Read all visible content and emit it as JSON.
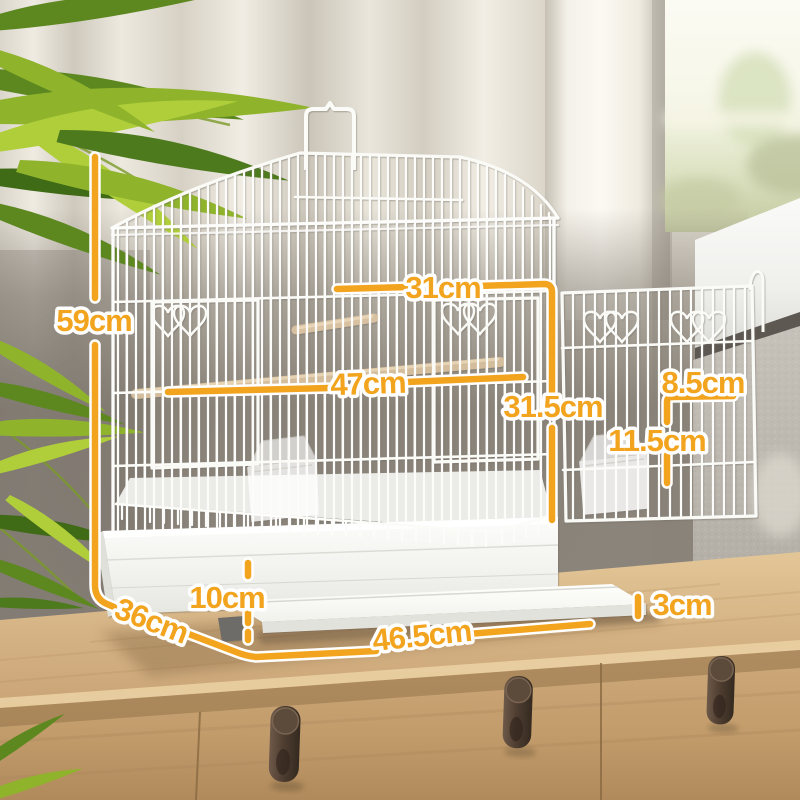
{
  "scene": {
    "objects": [
      "bird-cage",
      "open-side-door",
      "roof-carry-handle",
      "wooden-perches",
      "feeder-cups",
      "slide-out-tray",
      "white-base",
      "wooden-sideboard",
      "drawer-handles",
      "palm-plant",
      "curtains",
      "window",
      "gray-wall"
    ]
  },
  "dimensions": {
    "height": "59cm",
    "top_inner_width": "31cm",
    "perch_width": "47cm",
    "front_inner_height": "31.5cm",
    "door_width": "8.5cm",
    "door_height": "11.5cm",
    "base_height": "10cm",
    "depth": "36cm",
    "tray_width": "46.5cm",
    "tray_lip_height": "3cm"
  },
  "colors": {
    "dimension_accent": "#F3A41F",
    "dimension_text_outline": "#FFFFFF",
    "cage_wire": "#FBFBF9",
    "perch_wood": "#D4BD9C",
    "wood_top": "#D3B183",
    "wood_front": "#C19B6A",
    "handle_bronze": "#4F3E31",
    "wall_shadow": "#8B847C",
    "curtain": "#EAE5DB",
    "window_view": "#F6F6E8",
    "leaf_bright": "#AFCE3A",
    "leaf_dark": "#5D8820"
  }
}
